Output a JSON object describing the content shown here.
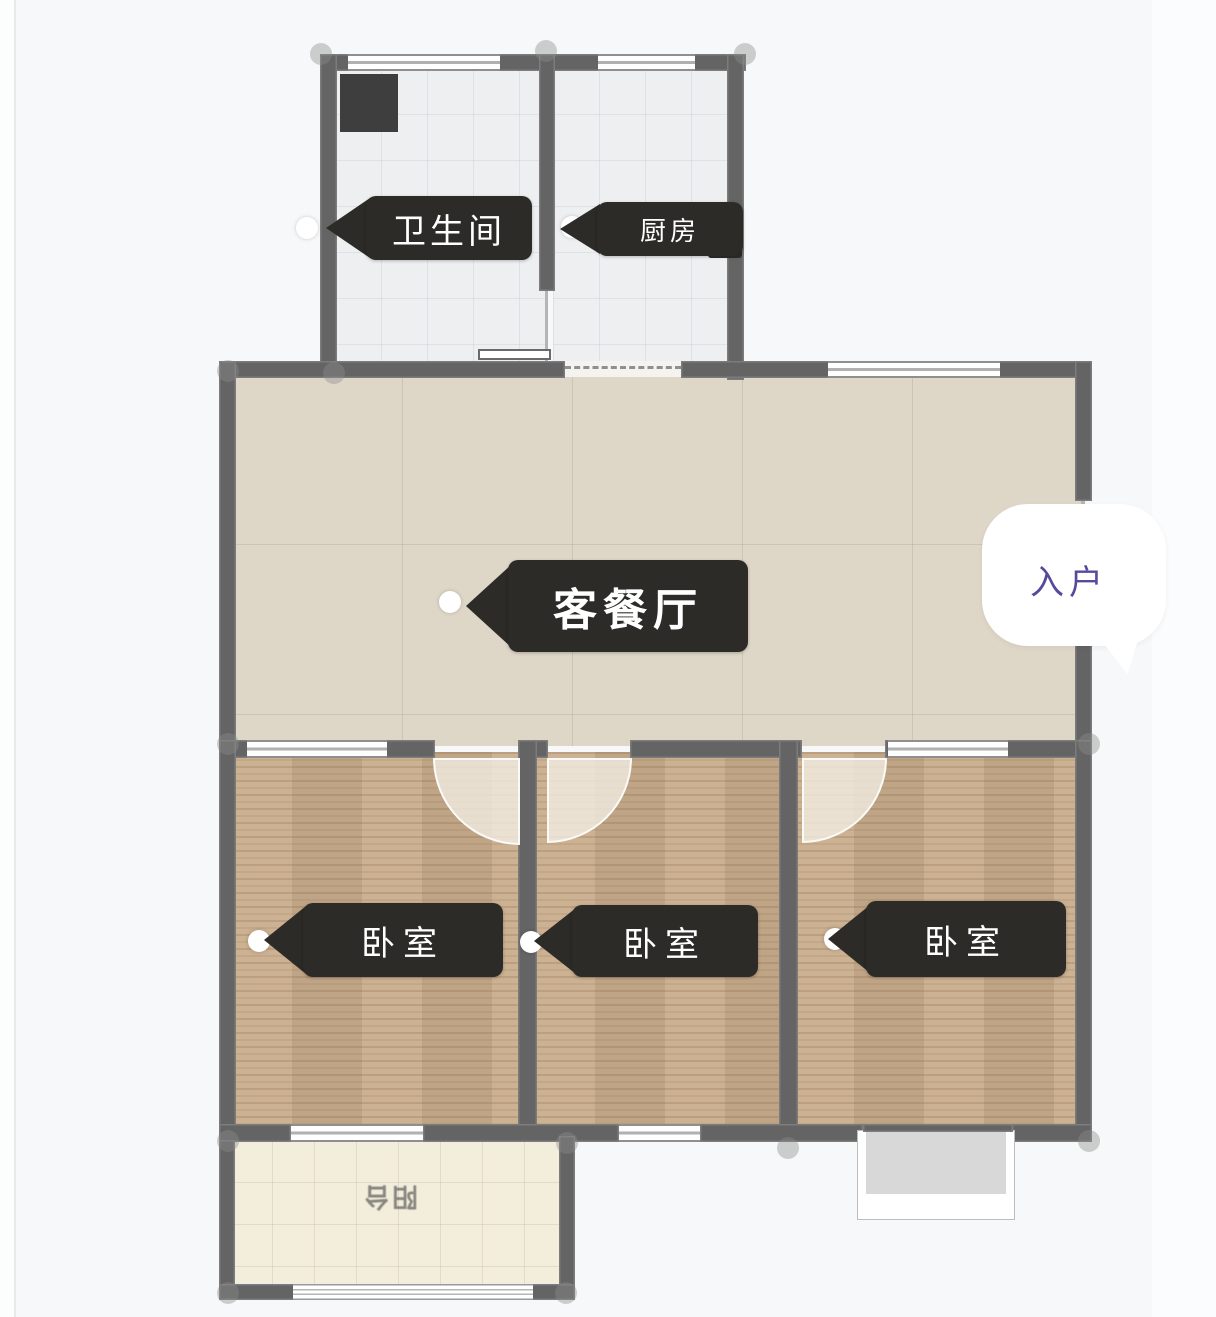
{
  "floorplan": {
    "title": "户型图",
    "rooms": [
      {
        "id": "bathroom",
        "label": "卫生间"
      },
      {
        "id": "kitchen",
        "label": "厨房"
      },
      {
        "id": "living-dining",
        "label": "客餐厅"
      },
      {
        "id": "bedroom-1",
        "label": "卧室"
      },
      {
        "id": "bedroom-2",
        "label": "卧室"
      },
      {
        "id": "bedroom-3",
        "label": "卧室"
      },
      {
        "id": "balcony",
        "label": "阳台"
      }
    ],
    "entrance": {
      "label": "入户"
    },
    "colors": {
      "wall": "#646464",
      "tag_background": "#2d2b27",
      "tag_text": "#ffffff",
      "entrance_text": "#564a9b",
      "wood_floor": "#c9ad8c",
      "living_floor": "#ded7c8",
      "tile_floor": "#edeff1",
      "balcony_floor": "#f3eddc",
      "page_background": "#f6f8f9"
    },
    "markers": {
      "room_dot": "white-circle"
    }
  }
}
